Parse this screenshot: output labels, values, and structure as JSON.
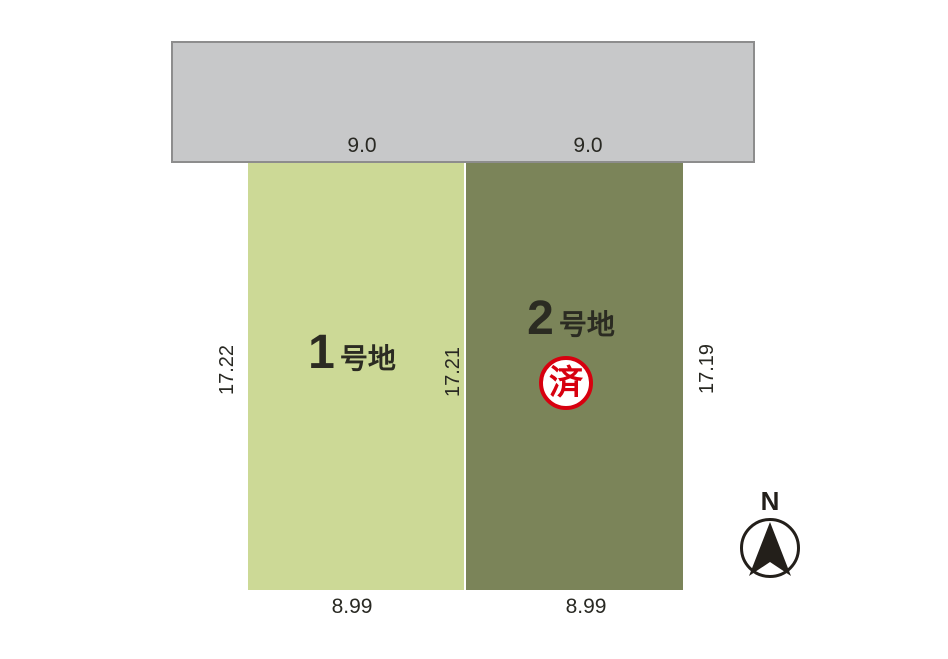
{
  "colors": {
    "background": "#ffffff",
    "road_fill": "#c7c8c9",
    "road_border": "#8d8d8d",
    "lot1_fill": "#ccd996",
    "lot2_fill": "#7b8459",
    "dimension_text": "#292923",
    "lot_label_text": "#2b2b22",
    "stamp_red": "#d7000f",
    "compass_black": "#231f1a"
  },
  "lots": [
    {
      "number": "1",
      "suffix": "号地",
      "top_dim": "9.0",
      "bottom_dim": "8.99",
      "side_dim_left": "17.22",
      "side_dim_right": "17.21"
    },
    {
      "number": "2",
      "suffix": "号地",
      "top_dim": "9.0",
      "bottom_dim": "8.99",
      "side_dim_right": "17.19",
      "stamp": "済"
    }
  ],
  "compass": {
    "label": "N"
  }
}
